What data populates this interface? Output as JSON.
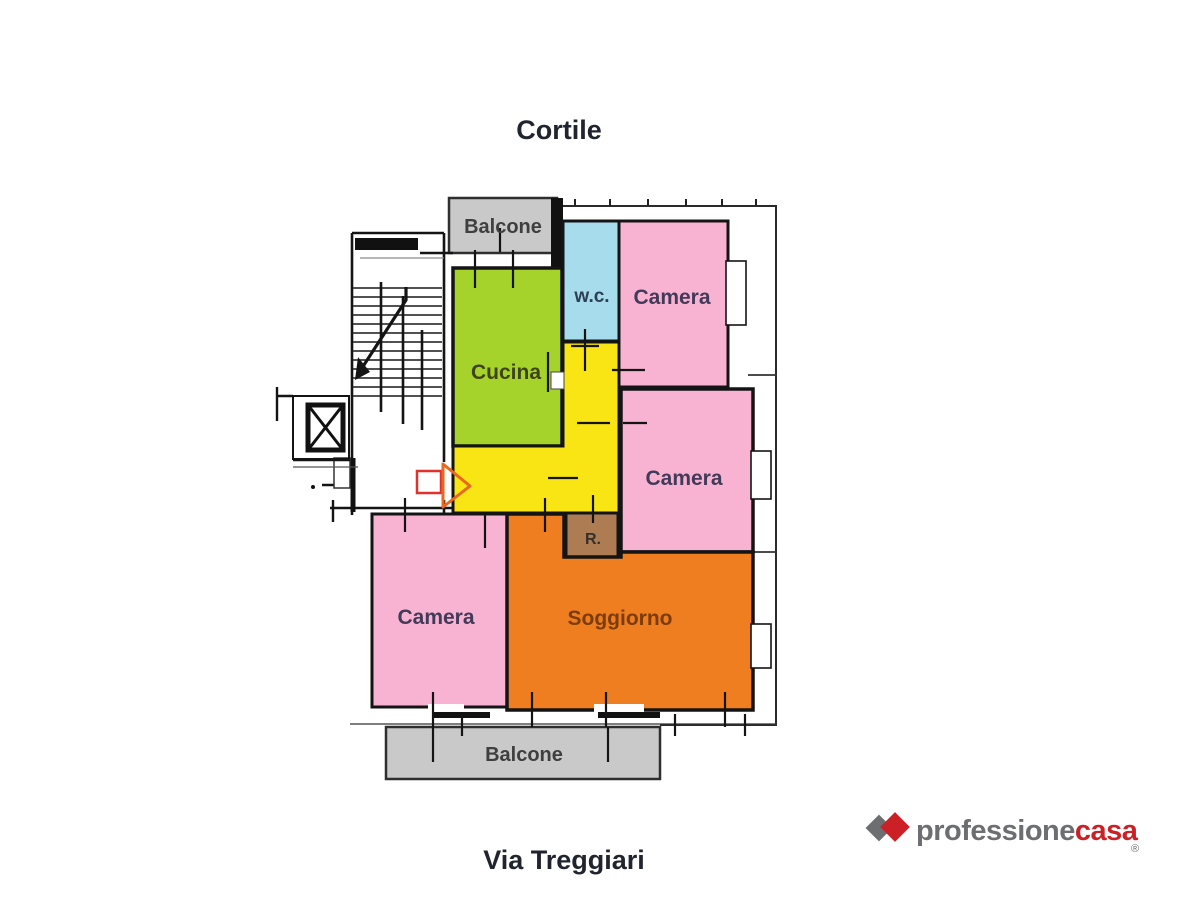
{
  "titles": {
    "top": "Cortile",
    "bottom": "Via Treggiari"
  },
  "rooms": {
    "balcone_top": {
      "label": "Balcone",
      "color": "#c9c9c9"
    },
    "wc": {
      "label": "w.c.",
      "color": "#a6dcec"
    },
    "camera_top": {
      "label": "Camera",
      "color": "#f8b3d2"
    },
    "cucina": {
      "label": "Cucina",
      "color": "#a5d32b"
    },
    "corridor": {
      "color": "#f9e513"
    },
    "ripostiglio": {
      "label": "R.",
      "color": "#ad7c53"
    },
    "camera_mid": {
      "label": "Camera",
      "color": "#f8b3d2"
    },
    "camera_bottom": {
      "label": "Camera",
      "color": "#f8b3d2"
    },
    "soggiorno": {
      "label": "Soggiorno",
      "color": "#ef7e20"
    },
    "balcone_bottom": {
      "label": "Balcone",
      "color": "#c9c9c9"
    }
  },
  "entrance_marker": {
    "rect_color": "#e0312c",
    "arrow_color": "#e8681f"
  },
  "logo": {
    "text_gray": "professione",
    "text_red": "casa",
    "registered": "®",
    "gray": "#6d6e71",
    "red": "#cb2026"
  }
}
